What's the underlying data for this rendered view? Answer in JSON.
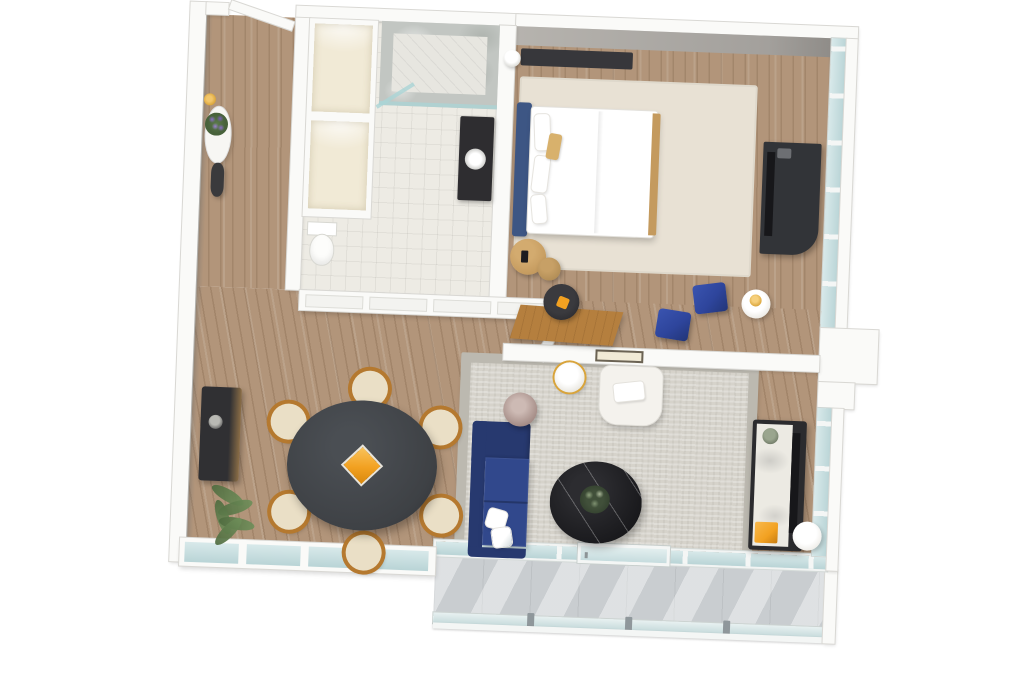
{
  "scene": {
    "title": "3D floor plan render — one-bedroom apartment suite with balcony",
    "view": "top-down 3D isometric render on white background"
  },
  "colors": {
    "wall": "#fafaf8",
    "wallEdge": "#d9d8d4",
    "wallFace": "#b6b3ae",
    "woodFloor": "#b2957a",
    "tileFloor": "#edebe4",
    "marble": "#c2c6c2",
    "glass": "#d8e9ea",
    "glassDeep": "#b9d4d6",
    "mullion": "#f4f6f5",
    "rug": "#d6d3cb",
    "rugBorder": "#bcb9b0",
    "bedRug": "#e8e1d4",
    "sofa": "#31488c",
    "sofaDark": "#27396f",
    "ottoman": "#2e459c",
    "accentOrange": "#f2a121",
    "headboard": "#3d5684",
    "bedding": "#ffffff",
    "pillowTan": "#d8b16c",
    "woodFurniture": "#b57f3e",
    "nightstand": "#c49a5e",
    "charcoal": "#3e4145",
    "black": "#17171a",
    "darkUnit": "#323438",
    "vanity": "#2e2d30",
    "cream": "#f1ead6",
    "marbleTop": "#eceae3",
    "drum": "#a68e88",
    "chairWood": "#b5792f",
    "chairSeat": "#eadfc6",
    "plant": "#6f8f5a",
    "flower": "#8a6fc6",
    "gold": "#d9a43a",
    "concrete": "#c9cdd0",
    "armchair": "#f4f2ed",
    "artFrame": "#6b6354"
  },
  "rooms": {
    "entry": {
      "name": "Entry hall",
      "furniture": [
        "open entry door",
        "oval console table",
        "purple flower arrangement",
        "dark floor vase",
        "brass wall lamp"
      ]
    },
    "bathroom": {
      "name": "Bathroom",
      "furniture": [
        "marble walk-in shower with glass door",
        "dark vanity with round sink",
        "toilet",
        "two cream closets"
      ]
    },
    "bedroom": {
      "name": "Bedroom",
      "furniture": [
        "double bed with navy headboard and tan accent pillow",
        "round wood nesting nightstands",
        "sphere lamp",
        "dark dresser with TV",
        "wood desk with stool",
        "two navy ottomans",
        "round table with gold lamp",
        "beige area rug"
      ]
    },
    "living": {
      "name": "Living room",
      "furniture": [
        "navy L-shaped sofa with white pillows",
        "black marble round coffee table with plant",
        "white armchair",
        "marble side table with gold rim",
        "drum side table",
        "media console with marble top and TV",
        "orange stool",
        "white pedestal table",
        "framed wall art",
        "gray area rug"
      ]
    },
    "dining": {
      "name": "Dining area",
      "furniture": [
        "round charcoal dining table",
        "orange diamond centerpiece",
        "six wood chairs with cream seats",
        "dark sideboard",
        "potted palm plant"
      ]
    },
    "balcony": {
      "name": "Balcony",
      "furniture": [
        "concrete floor",
        "glass railing with posts",
        "sliding glass door",
        "floor-to-ceiling window walls"
      ]
    }
  }
}
